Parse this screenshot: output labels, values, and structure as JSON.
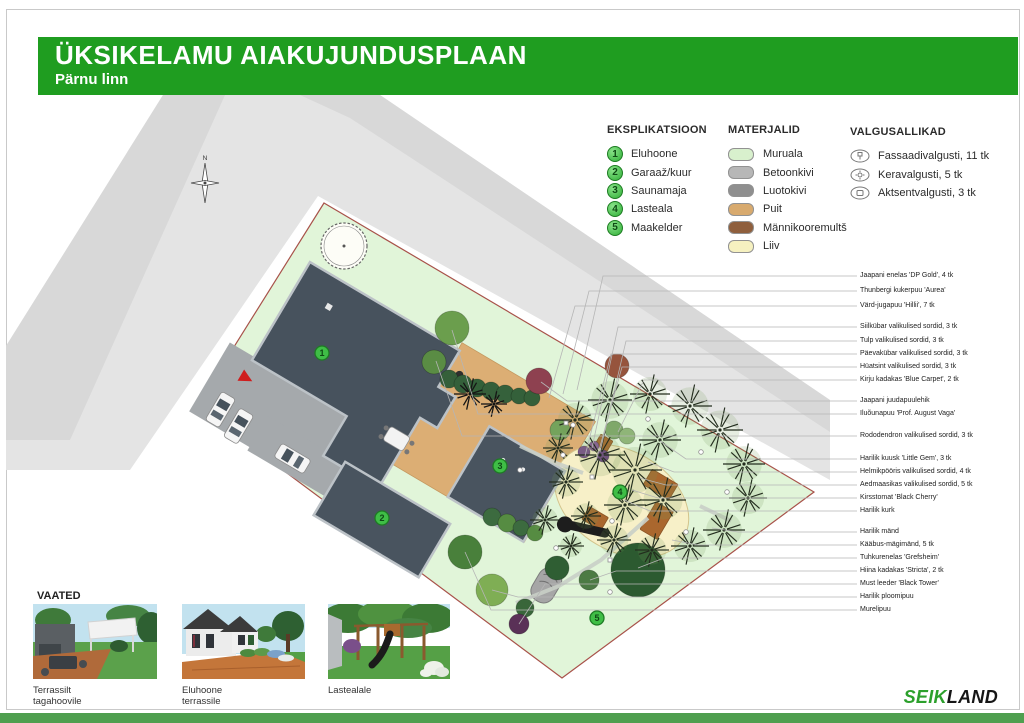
{
  "header": {
    "title": "ÜKSIKELAMU AIAKUJUNDUSPLAAN",
    "subtitle": "Pärnu linn"
  },
  "colors": {
    "header_green": "#1f9d20",
    "footer_green": "#4f9f4f",
    "logo_green": "#2ca02c",
    "property_green": "#e1f5d9",
    "property_border": "#a8524a",
    "building_gray": "#47525d",
    "road_gray": "#e4e4e4",
    "driveway_gray": "#a5a9ac",
    "terrace_wood": "#dcae74",
    "sand": "#f7f0c8"
  },
  "eksplikatsioon": {
    "title": "EKSPLIKATSIOON",
    "items": [
      {
        "num": "1",
        "label": "Eluhoone"
      },
      {
        "num": "2",
        "label": "Garaaž/kuur"
      },
      {
        "num": "3",
        "label": "Saunamaja"
      },
      {
        "num": "4",
        "label": "Lasteala"
      },
      {
        "num": "5",
        "label": "Maakelder"
      }
    ]
  },
  "materials": {
    "title": "MATERJALID",
    "items": [
      {
        "label": "Muruala",
        "color": "#d8f0cd"
      },
      {
        "label": "Betoonkivi",
        "color": "#b7b7b7"
      },
      {
        "label": "Luotokivi",
        "color": "#8f8f8f"
      },
      {
        "label": "Puit",
        "color": "#d8aa6e"
      },
      {
        "label": "Männikooremultš",
        "color": "#8f5f3d"
      },
      {
        "label": "Liiv",
        "color": "#f6f1c0"
      }
    ]
  },
  "lights": {
    "title": "VALGUSALLIKAD",
    "items": [
      {
        "icon": "facade-light",
        "label": "Fassaadivalgusti, 11 tk"
      },
      {
        "icon": "sphere-light",
        "label": "Keravalgusti, 5 tk"
      },
      {
        "icon": "accent-light",
        "label": "Aktsentvalgusti, 3 tk"
      }
    ]
  },
  "plant_labels": [
    {
      "label": "Jaapani enelas 'DP Gold', 4 tk",
      "y": 276,
      "tx": 577,
      "ty": 390
    },
    {
      "label": "Thunbergi kukerpuu 'Aurea'",
      "y": 291,
      "tx": 563,
      "ty": 394
    },
    {
      "label": "Värd-jugapuu 'Hillii', 7 tk",
      "y": 306,
      "tx": 549,
      "ty": 398
    },
    {
      "label": "Siilkübar valikulised sordid, 3 tk",
      "y": 327,
      "tx": 592,
      "ty": 448
    },
    {
      "label": "Tulp valikulised sordid, 3 tk",
      "y": 341,
      "tx": 600,
      "ty": 452
    },
    {
      "label": "Päevakübar valikulised sordid, 3 tk",
      "y": 354,
      "tx": 585,
      "ty": 456
    },
    {
      "label": "Hüatsint valikulised sordid, 3 tk",
      "y": 367,
      "tx": 596,
      "ty": 461
    },
    {
      "label": "Kirju kadakas 'Blue Carpet', 2 tk",
      "y": 380,
      "tx": 618,
      "ty": 432
    },
    {
      "label": "Jaapani juudapuulehik",
      "y": 401,
      "tx": 541,
      "ty": 382
    },
    {
      "label": "Iluõunapuu 'Prof. August Vaga'",
      "y": 414,
      "tx": 452,
      "ty": 330
    },
    {
      "label": "Rododendron valikulised sordid, 3 tk",
      "y": 436,
      "tx": 436,
      "ty": 361
    },
    {
      "label": "Harilik kuusk 'Little Gem', 3 tk",
      "y": 459,
      "tx": 660,
      "ty": 441
    },
    {
      "label": "Helmikpööris valikulised sordid, 4 tk",
      "y": 472,
      "tx": 648,
      "ty": 462
    },
    {
      "label": "Aedmaasikas valikulised sordid, 5 tk",
      "y": 485,
      "tx": 640,
      "ty": 478
    },
    {
      "label": "Kirsstomat 'Black Cherry'",
      "y": 498,
      "tx": 632,
      "ty": 490
    },
    {
      "label": "Harilik kurk",
      "y": 511,
      "tx": 624,
      "ty": 500
    },
    {
      "label": "Harilik mänd",
      "y": 532,
      "tx": 712,
      "ty": 528
    },
    {
      "label": "Kääbus-mägimänd, 5 tk",
      "y": 545,
      "tx": 672,
      "ty": 540
    },
    {
      "label": "Tuhkurenelas 'Grefsheim'",
      "y": 558,
      "tx": 638,
      "ty": 568
    },
    {
      "label": "Hiina kadakas 'Stricta', 2 tk",
      "y": 571,
      "tx": 590,
      "ty": 580
    },
    {
      "label": "Must leeder 'Black Tower'",
      "y": 584,
      "tx": 519,
      "ty": 624
    },
    {
      "label": "Harilik ploomipuu",
      "y": 597,
      "tx": 492,
      "ty": 590
    },
    {
      "label": "Murelipuu",
      "y": 610,
      "tx": 465,
      "ty": 552
    }
  ],
  "plan": {
    "compass": "N",
    "rotation_deg": 30.6,
    "origin": [
      324,
      203
    ],
    "property_points": "324,203 814,492 562,678 197,406",
    "roads": {
      "base": "163,95 380,95 830,400 830,480 318,196 130,470 6,470 6,346",
      "stripes": [
        "380,95 830,400 830,432 350,118 300,95",
        "163,95 225,95 70,440 6,440 6,346"
      ]
    },
    "badges": [
      {
        "n": "1",
        "x": 322,
        "y": 353
      },
      {
        "n": "2",
        "x": 382,
        "y": 518
      },
      {
        "n": "3",
        "x": 500,
        "y": 466
      },
      {
        "n": "4",
        "x": 620,
        "y": 492
      },
      {
        "n": "5",
        "x": 597,
        "y": 618
      }
    ],
    "trees": [
      {
        "x": 452,
        "y": 328,
        "r": 17,
        "c": "#6b9e4d"
      },
      {
        "x": 434,
        "y": 362,
        "r": 12,
        "c": "#5a8c44"
      },
      {
        "x": 449,
        "y": 379,
        "r": 9,
        "c": "#35603a"
      },
      {
        "x": 463,
        "y": 384,
        "r": 9,
        "c": "#34603a"
      },
      {
        "x": 477,
        "y": 388,
        "r": 9,
        "c": "#336039"
      },
      {
        "x": 491,
        "y": 391,
        "r": 9,
        "c": "#355f3a"
      },
      {
        "x": 505,
        "y": 394,
        "r": 9,
        "c": "#35613b"
      },
      {
        "x": 519,
        "y": 396,
        "r": 8,
        "c": "#34603a"
      },
      {
        "x": 532,
        "y": 398,
        "r": 8,
        "c": "#356039"
      },
      {
        "x": 539,
        "y": 381,
        "r": 13,
        "c": "#8e4150"
      },
      {
        "x": 617,
        "y": 366,
        "r": 12,
        "c": "#96543d"
      },
      {
        "x": 584,
        "y": 452,
        "r": 6,
        "c": "#7b4f8e"
      },
      {
        "x": 594,
        "y": 446,
        "r": 5,
        "c": "#8a5b9b"
      },
      {
        "x": 603,
        "y": 456,
        "r": 6,
        "c": "#6d4482"
      },
      {
        "x": 614,
        "y": 430,
        "r": 9,
        "c": "#7fa86a"
      },
      {
        "x": 627,
        "y": 436,
        "r": 8,
        "c": "#8fb578"
      },
      {
        "x": 560,
        "y": 430,
        "r": 10,
        "c": "#74a35c"
      },
      {
        "x": 492,
        "y": 517,
        "r": 9,
        "c": "#3c6b3f"
      },
      {
        "x": 507,
        "y": 523,
        "r": 9,
        "c": "#568c42"
      },
      {
        "x": 521,
        "y": 528,
        "r": 8,
        "c": "#3c6b3f"
      },
      {
        "x": 535,
        "y": 533,
        "r": 8,
        "c": "#568c42"
      },
      {
        "x": 465,
        "y": 552,
        "r": 17,
        "c": "#49803b"
      },
      {
        "x": 492,
        "y": 590,
        "r": 16,
        "c": "#7fae54"
      },
      {
        "x": 525,
        "y": 608,
        "r": 9,
        "c": "#39663a"
      },
      {
        "x": 519,
        "y": 624,
        "r": 10,
        "c": "#5a3157"
      },
      {
        "x": 557,
        "y": 568,
        "r": 12,
        "c": "#2f5e33"
      },
      {
        "x": 589,
        "y": 580,
        "r": 10,
        "c": "#4c7a44"
      },
      {
        "x": 638,
        "y": 570,
        "r": 27,
        "c": "#2c5a30"
      }
    ],
    "formal_tree": {
      "x": 344,
      "y": 246,
      "r": 23
    },
    "pines": [
      [
        575,
        420,
        20
      ],
      [
        610,
        400,
        22
      ],
      [
        650,
        394,
        20
      ],
      [
        690,
        406,
        22
      ],
      [
        720,
        430,
        23
      ],
      [
        744,
        464,
        21
      ],
      [
        748,
        498,
        19
      ],
      [
        724,
        530,
        21
      ],
      [
        690,
        546,
        19
      ],
      [
        652,
        550,
        17
      ],
      [
        614,
        540,
        17
      ],
      [
        586,
        516,
        15
      ],
      [
        566,
        482,
        17
      ],
      [
        558,
        448,
        15
      ],
      [
        600,
        455,
        25
      ],
      [
        635,
        470,
        27
      ],
      [
        663,
        500,
        23
      ],
      [
        625,
        505,
        21
      ],
      [
        660,
        440,
        21
      ],
      [
        545,
        520,
        15
      ],
      [
        571,
        546,
        13
      ]
    ],
    "bursts": [
      [
        470,
        394,
        16
      ],
      [
        494,
        404,
        13
      ]
    ],
    "light_points": [
      [
        573,
        425
      ],
      [
        648,
        419
      ],
      [
        701,
        452
      ],
      [
        727,
        492
      ],
      [
        686,
        532
      ],
      [
        612,
        521
      ],
      [
        563,
        455
      ],
      [
        520,
        470
      ],
      [
        556,
        548
      ],
      [
        610,
        592
      ]
    ],
    "square_points": [
      [
        566,
        423
      ],
      [
        592,
        477
      ],
      [
        610,
        560
      ]
    ],
    "paths": [
      "520,446 556,463 583,473",
      "648,518 601,560 559,586 516,603",
      "700,506 731,521"
    ]
  },
  "views": {
    "title": "VAATED",
    "items": [
      {
        "caption": "Terrassilt tagahoovile"
      },
      {
        "caption": "Eluhoone terrassile"
      },
      {
        "caption": "Lastealale"
      }
    ]
  },
  "logo": {
    "seik": "SEIK",
    "land": "LAND"
  }
}
